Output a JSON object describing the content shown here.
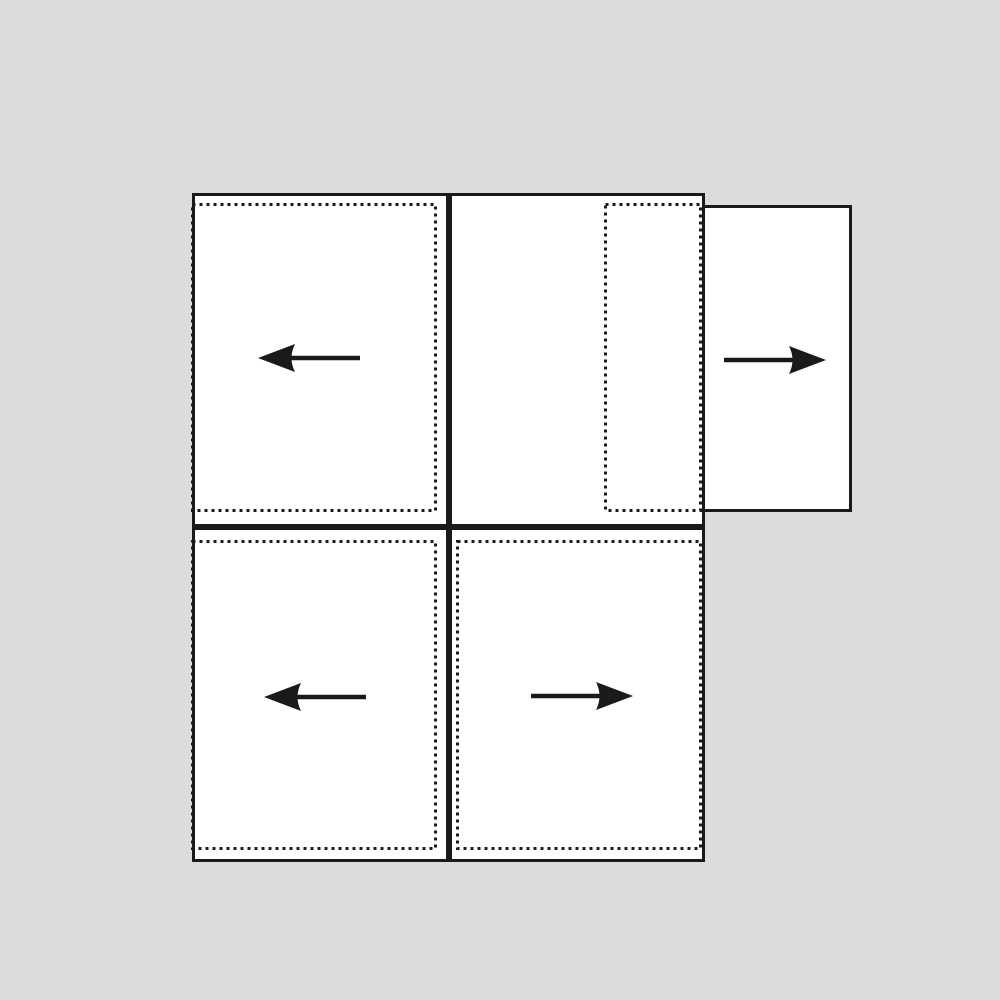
{
  "diagram": {
    "title": "sliding-panel-direction-diagram",
    "background_color": "#dcdcdc",
    "line_color": "#1a1a1a",
    "panel_fill_color": "#ffffff",
    "panels": [
      {
        "id": "top-left",
        "dotted_outline": "full-panel",
        "arrow": "left"
      },
      {
        "id": "top-middle",
        "dotted_outline": "right-portion",
        "arrow": "none"
      },
      {
        "id": "top-right",
        "dotted_outline": "none",
        "arrow": "right"
      },
      {
        "id": "bottom-left",
        "dotted_outline": "full-panel",
        "arrow": "left"
      },
      {
        "id": "bottom-right",
        "dotted_outline": "full-panel",
        "arrow": "right"
      }
    ],
    "icons": {
      "left_arrow": "left-arrow-icon",
      "right_arrow": "right-arrow-icon"
    }
  }
}
